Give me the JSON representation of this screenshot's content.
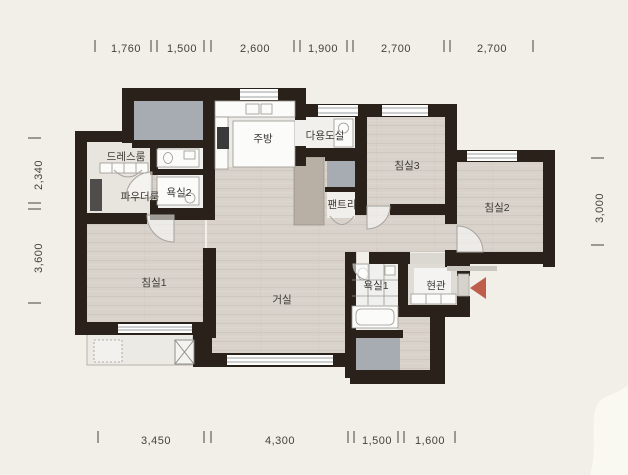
{
  "plan": {
    "type": "apartment-floor-plan",
    "rooms": {
      "dress": {
        "label": "드레스룸"
      },
      "powder": {
        "label": "파우더룸"
      },
      "bath2": {
        "label": "욕실2"
      },
      "kitchen": {
        "label": "주방"
      },
      "utility": {
        "label": "다용도실"
      },
      "pantry": {
        "label": "팬트리"
      },
      "bed3": {
        "label": "침실3"
      },
      "bed2": {
        "label": "침실2"
      },
      "bed1": {
        "label": "침실1"
      },
      "living": {
        "label": "거실"
      },
      "bath1": {
        "label": "욕실1"
      },
      "entry": {
        "label": "현관"
      }
    },
    "dimensions": {
      "top": [
        "1,760",
        "1,500",
        "2,600",
        "1,900",
        "2,700",
        "2,700"
      ],
      "bottom": [
        "3,450",
        "4,300",
        "1,500",
        "1,600"
      ],
      "left": [
        "2,340",
        "3,600"
      ],
      "right": [
        "3,000"
      ]
    },
    "colors": {
      "background": "#f2efe9",
      "wall": "#2a221a",
      "floor_wood": "#d8d2cb",
      "duct_gray": "#a7acb2",
      "storage_taupe": "#b8afa5",
      "entry_arrow": "#bf5f4b",
      "dim_text": "#45423c"
    }
  }
}
